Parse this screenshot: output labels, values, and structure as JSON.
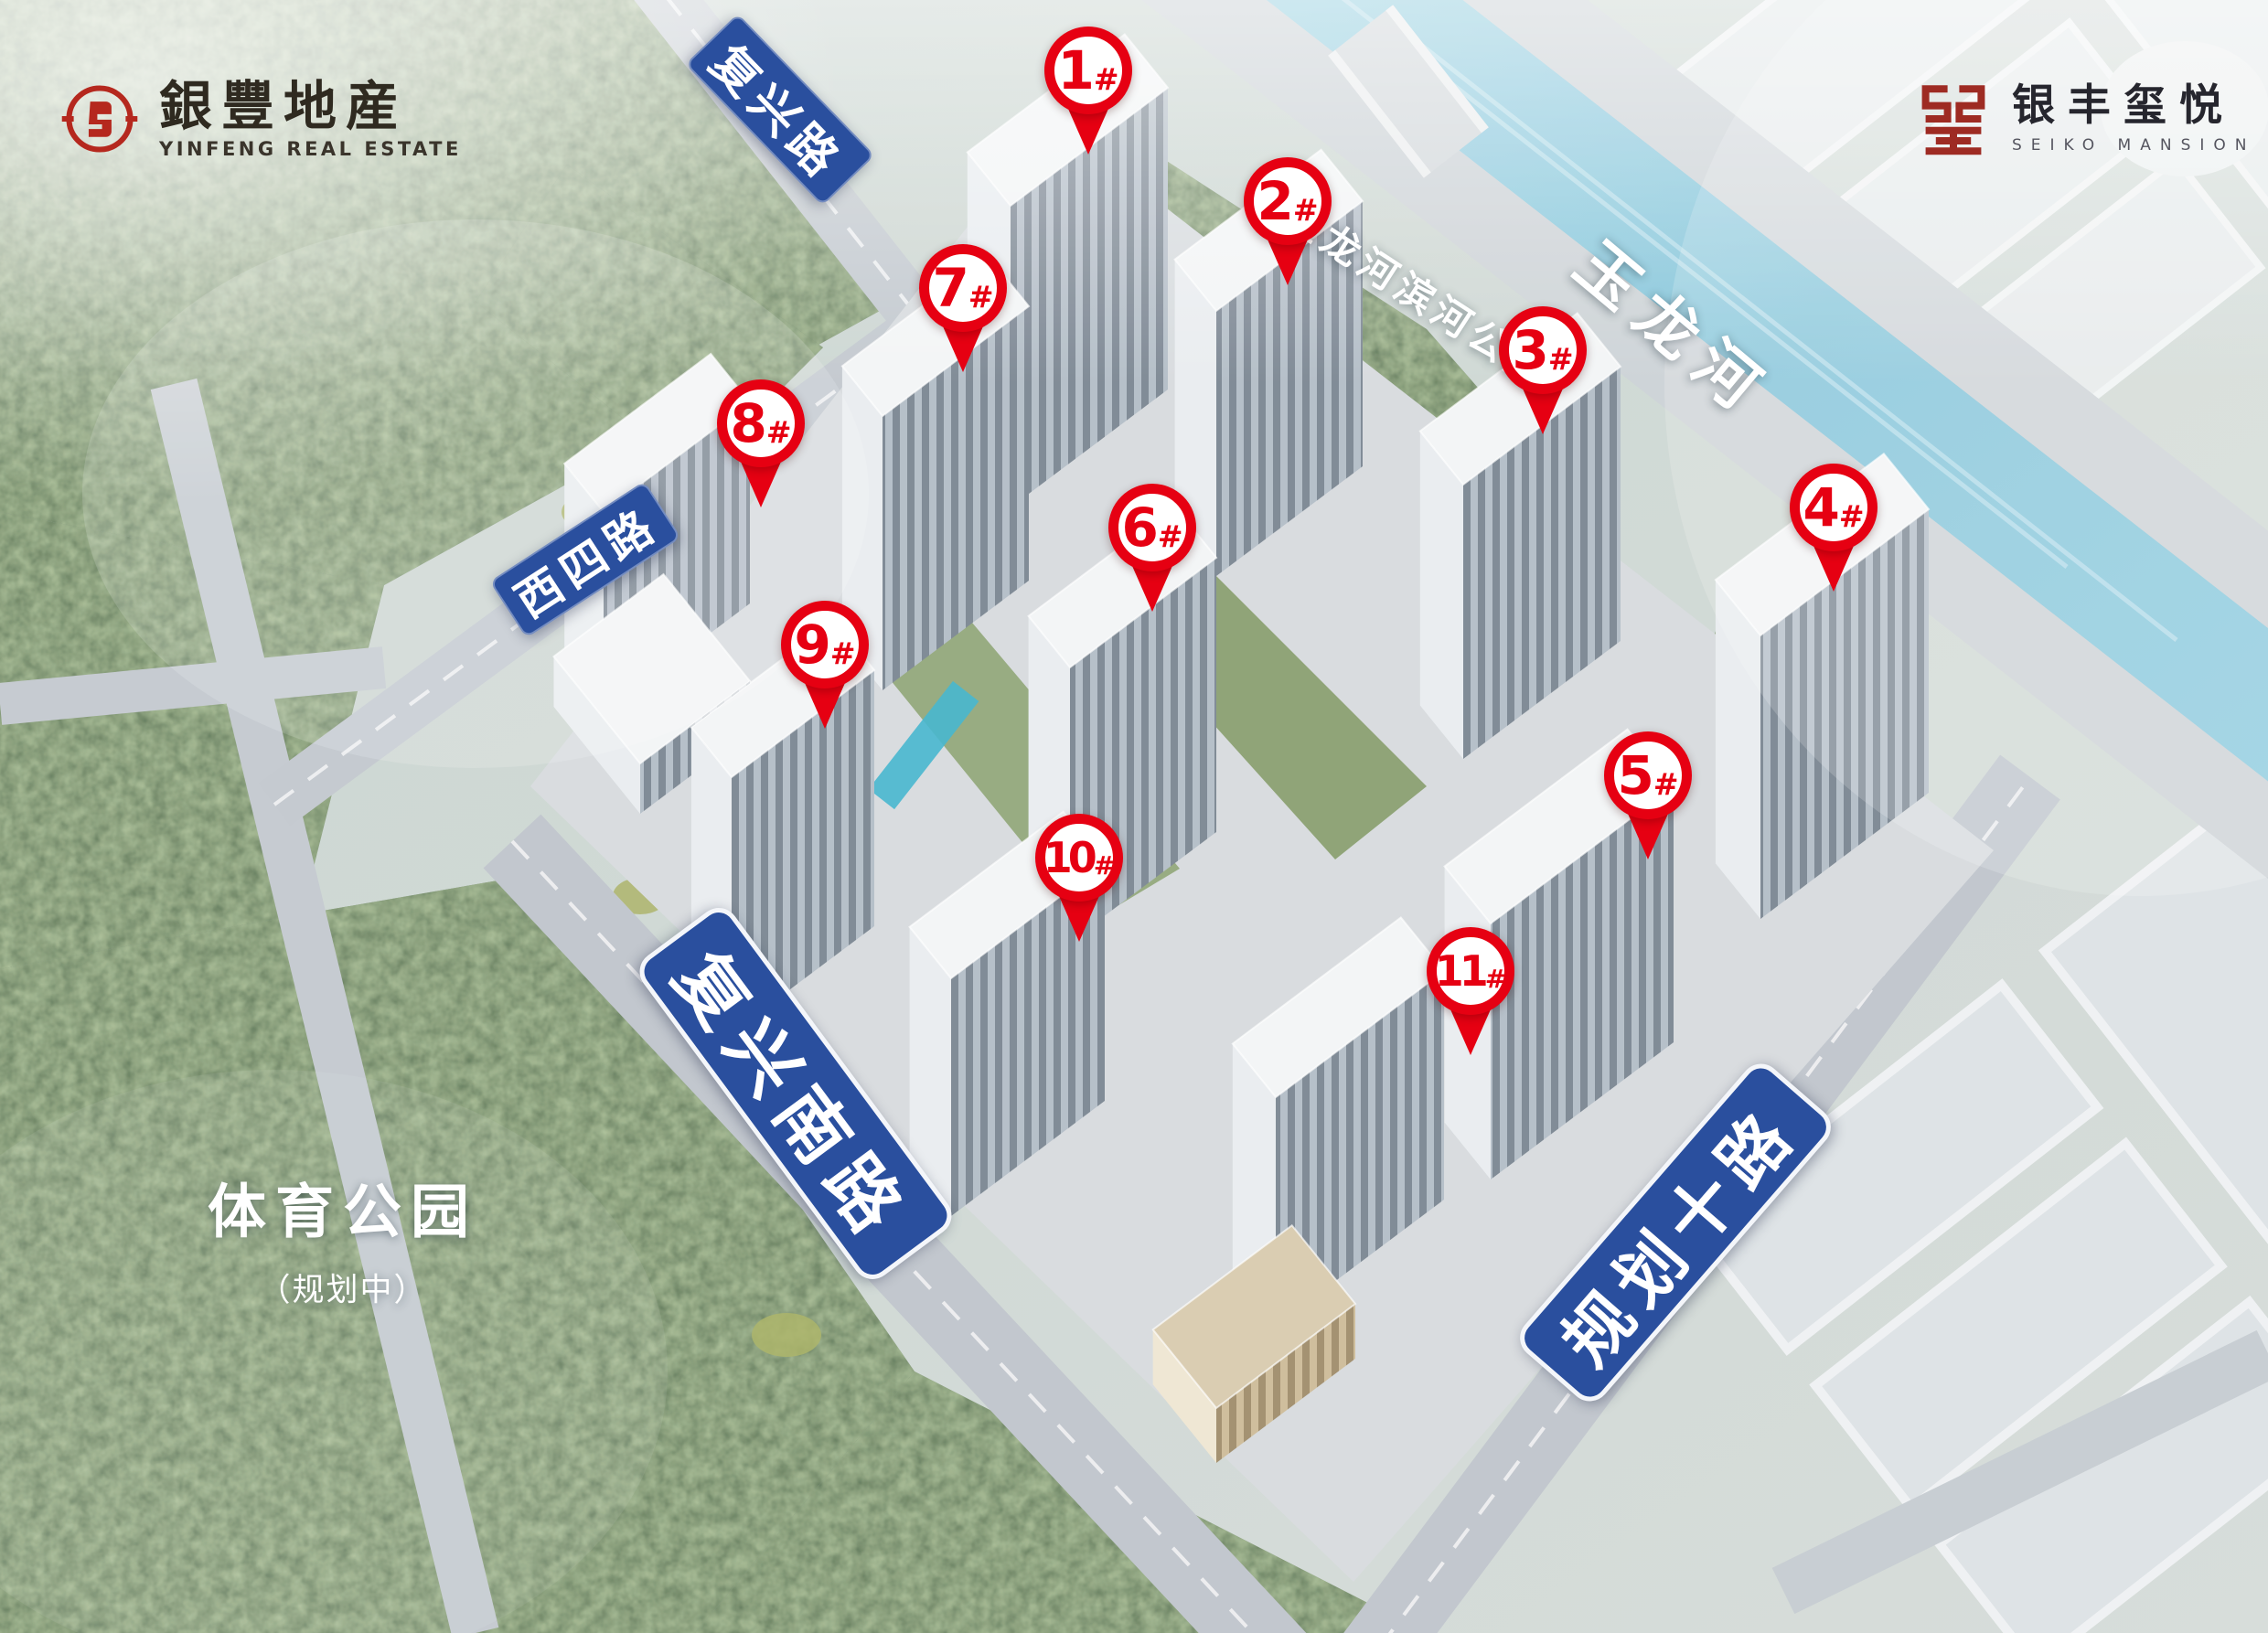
{
  "branding": {
    "yinfeng": {
      "cn": "銀豐地産",
      "en": "YINFENG REAL ESTATE"
    },
    "seiko": {
      "cn": "银丰玺悦",
      "en": "SEIKO MANSION"
    }
  },
  "road_labels": {
    "fuxing": "复兴路",
    "xisi": "西四路",
    "fuxing_south": "复兴南路",
    "planned10": "规划十路"
  },
  "water_labels": {
    "river": "玉龙河",
    "riverside_park": "玉龙河滨河公园"
  },
  "area_labels": {
    "sports_park": "体育公园",
    "sports_park_note": "（规划中）"
  },
  "building_markers": [
    {
      "label": "1#",
      "num": "1",
      "suffix": "#"
    },
    {
      "label": "2#",
      "num": "2",
      "suffix": "#"
    },
    {
      "label": "3#",
      "num": "3",
      "suffix": "#"
    },
    {
      "label": "4#",
      "num": "4",
      "suffix": "#"
    },
    {
      "label": "5#",
      "num": "5",
      "suffix": "#"
    },
    {
      "label": "6#",
      "num": "6",
      "suffix": "#"
    },
    {
      "label": "7#",
      "num": "7",
      "suffix": "#"
    },
    {
      "label": "8#",
      "num": "8",
      "suffix": "#"
    },
    {
      "label": "9#",
      "num": "9",
      "suffix": "#"
    },
    {
      "label": "10#",
      "num": "10",
      "suffix": "#"
    },
    {
      "label": "11#",
      "num": "11",
      "suffix": "#"
    }
  ],
  "colors": {
    "marker_red": "#e60012",
    "road_sign_blue": "#2a4f9e",
    "river_blue": "#8ac6da",
    "forest_green": "#4d6749",
    "seal_red": "#b5281e",
    "monogram_red": "#9e2b23",
    "label_white": "#ffffff"
  }
}
